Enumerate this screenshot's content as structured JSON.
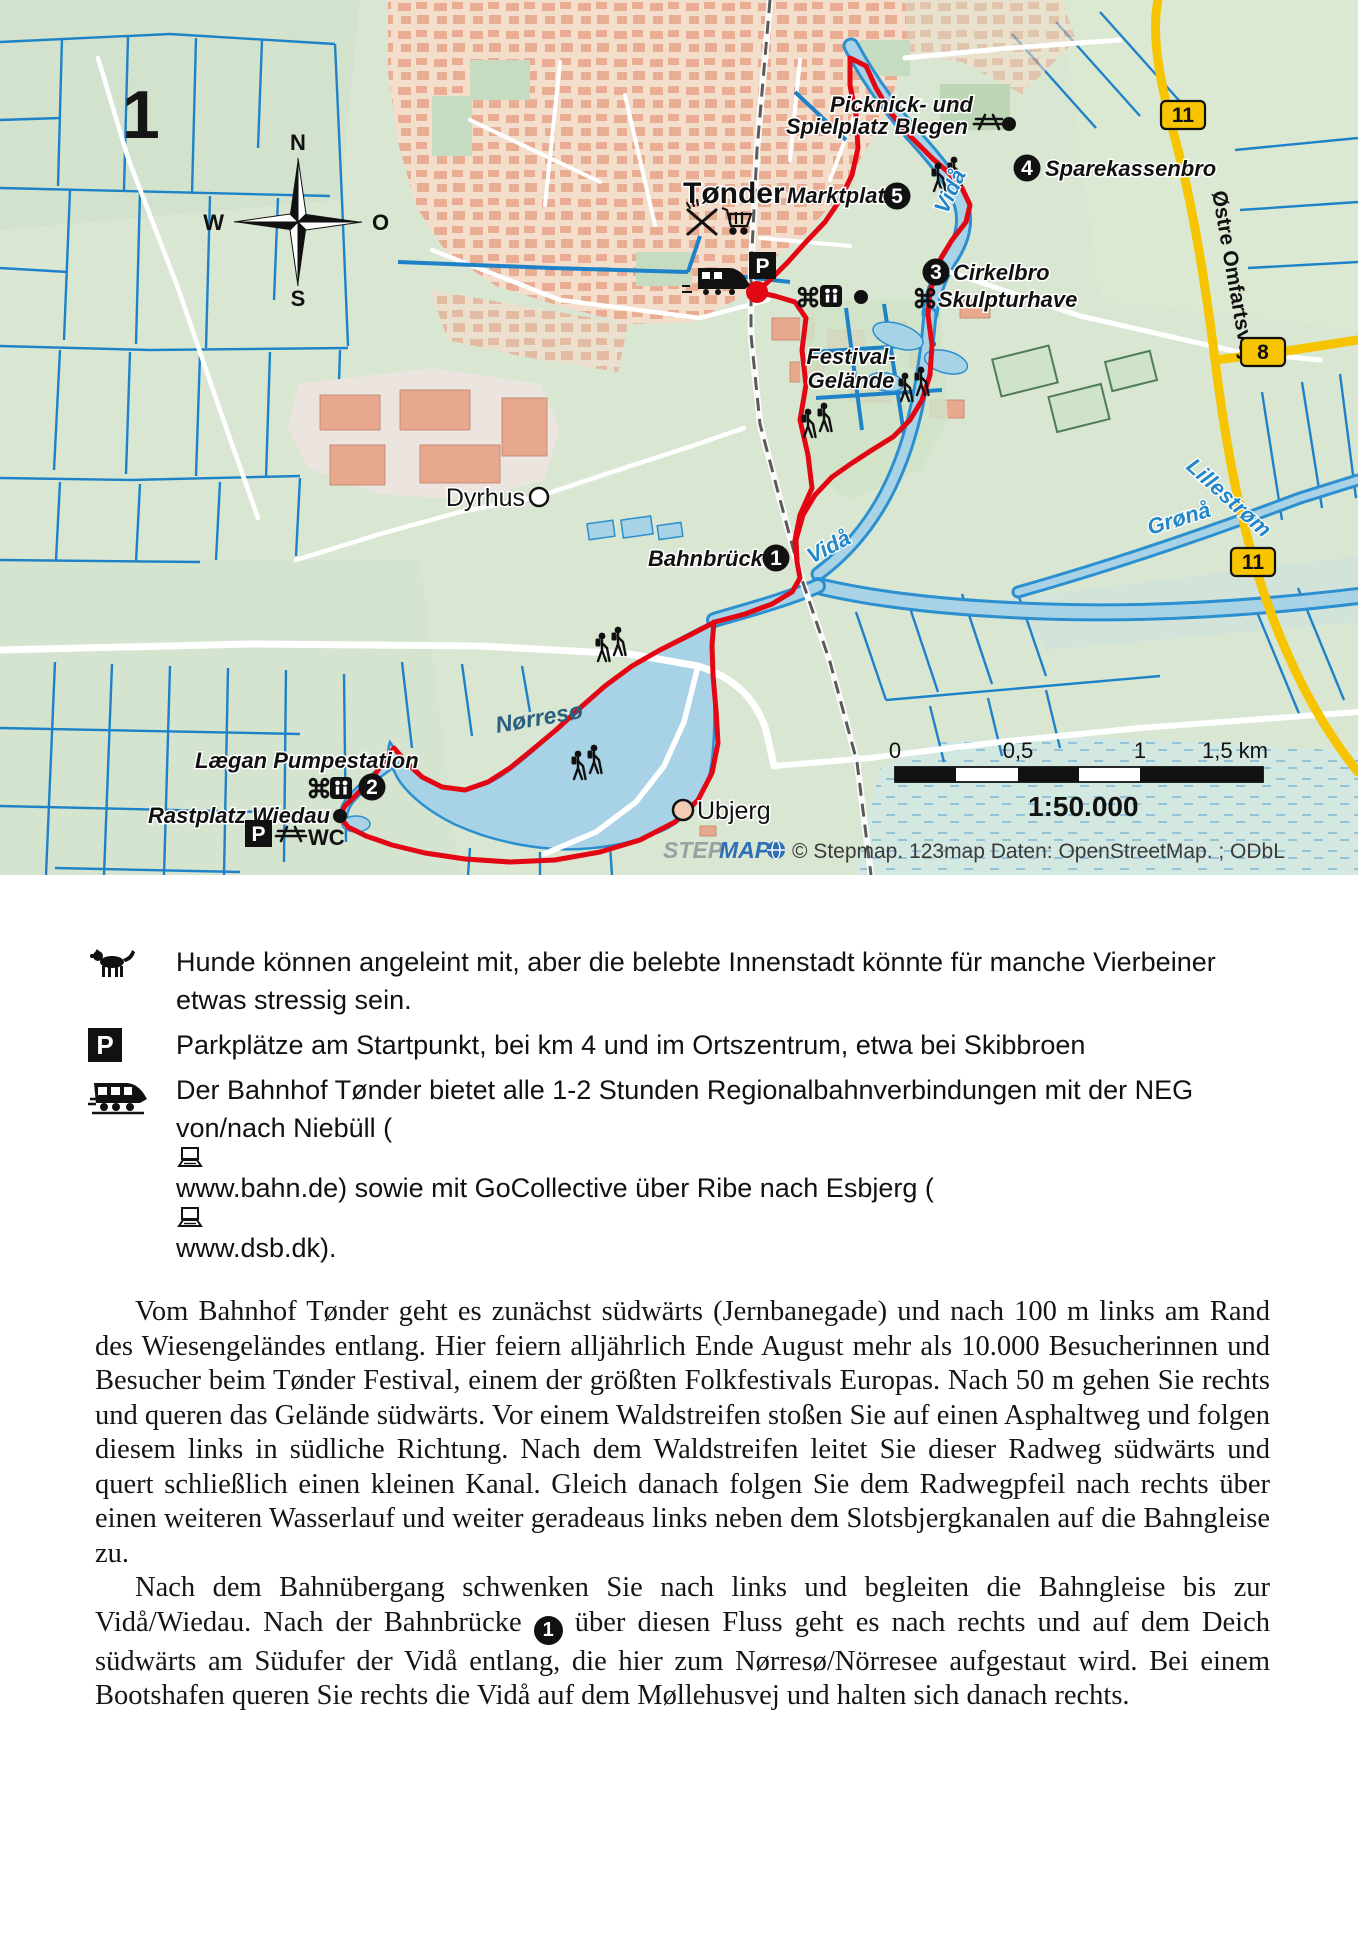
{
  "page": {
    "tour_number": "1"
  },
  "map": {
    "compass": {
      "n": "N",
      "w": "W",
      "o": "O",
      "s": "S"
    },
    "labels": {
      "town": "Tønder",
      "marktplatz": "Marktplatz",
      "picknick_line1": "Picknick- und",
      "picknick_line2": "Spielplatz Blegen",
      "sparekassenbro": "Sparekassenbro",
      "cirkelbro": "Cirkelbro",
      "skulpturhave": "Skulpturhave",
      "festival_line1": "Festival-",
      "festival_line2": "Gelände",
      "dyrhus": "Dyrhus",
      "bahnbruecke": "Bahnbrücke",
      "vida": "Vidå",
      "groenaa": "Grønå",
      "lillestroem": "Lillestrøm",
      "oestre_omfartsvej": "Østre Omfartsvej",
      "noerresoe": "Nørresø",
      "laegan_pumpestation": "Lægan Pumpestation",
      "rastplatz_wiedau": "Rastplatz Wiedau",
      "wc": "WC",
      "parking": "P",
      "ubjerg": "Ubjerg",
      "poi_symbol": "⌘"
    },
    "markers": {
      "m1": "1",
      "m2": "2",
      "m3": "3",
      "m4": "4",
      "m5": "5"
    },
    "road_badges": {
      "b11_top": "11",
      "b8": "8",
      "b11_bottom": "11"
    },
    "scale": {
      "t0": "0",
      "t05": "0,5",
      "t1": "1",
      "t15": "1,5 km",
      "ratio": "1:50.000"
    },
    "attribution": {
      "logo_step": "STEP",
      "logo_map": "MAP",
      "text": "© Stepmap. 123map Daten: OpenStreetMap. ; ODbL"
    },
    "colors": {
      "route": "#e30613",
      "water": "#2b8fd0",
      "water_fill": "#a8d2e6",
      "road_yellow": "#f6c400",
      "land": "#d9e6d2",
      "urban": "#f3ddcb",
      "building": "#e7a88d"
    }
  },
  "legend": {
    "dog_text": "Hunde können angeleint mit, aber die belebte Innenstadt könnte für manche Vierbeiner etwas stressig sein.",
    "parking_letter": "P",
    "parking_text": "Parkplätze am Startpunkt, bei km 4 und im Ortszentrum, etwa bei Skibbroen",
    "train_text_1": "Der Bahnhof Tønder bietet alle 1-2 Stunden Regionalbahnverbindungen mit der NEG von/nach Niebüll (",
    "train_text_2": "www.bahn.de) sowie mit GoCollective über Ribe nach Esbjerg (",
    "train_text_3": "www.dsb.dk)."
  },
  "body": {
    "para1": "Vom Bahnhof Tønder geht es zunächst südwärts (Jernbanegade) und nach 100 m links am Rand des Wiesengeländes entlang. Hier feiern alljährlich Ende August mehr als 10.000 Besucherinnen und Besucher beim Tønder Festival, einem der größten Folkfestivals Europas. Nach 50 m gehen Sie rechts und queren das Gelände südwärts. Vor einem Waldstreifen stoßen Sie auf einen Asphaltweg und folgen diesem links in südliche Richtung. Nach dem Waldstreifen leitet Sie dieser Radweg südwärts und quert schließlich einen kleinen Kanal. Gleich danach folgen Sie dem Radwegpfeil nach rechts über einen weiteren Wasserlauf und weiter geradeaus links neben dem Slotsbjergkanalen auf die Bahngleise zu.",
    "para2_before": "Nach dem Bahnübergang schwenken Sie nach links und begleiten die Bahngleise bis zur Vidå/Wiedau. Nach der Bahnbrücke",
    "para2_marker": "1",
    "para2_after": "über diesen Fluss geht es nach rechts und auf dem Deich südwärts am Südufer der Vidå entlang, die hier zum Nørresø/Nörresee aufgestaut wird. Bei einem Bootshafen queren Sie rechts die Vidå auf dem Møllehusvej und halten sich danach rechts."
  }
}
